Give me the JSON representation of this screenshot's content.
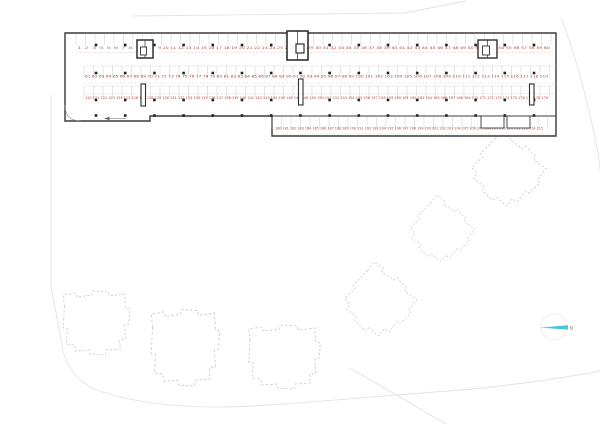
{
  "north": {
    "label": "N"
  },
  "colors": {
    "stall_number_red": "#b0443c",
    "stall_number_gray": "#8f8f8f",
    "north_needle": "#4ac4d8",
    "walls": "#383838"
  },
  "parking_rows": {
    "row1_left": "1 2 3 4 5 6 7 8",
    "row1": "9 10 11 12 13 14 15 16 17 18 19 20 21 22 23 24 25 26 27 28 29 30 31 32 33 34 35 36 37 38 39 40 41 42 43 44 45 46 47 48 49 50 51 52 53 54 55 56 57 58 59 60",
    "row2": "61 62 63 64 65 66 67 68 69 70 71 72 73 74 75 76 77 78 79 80 81 82 83 84 85 86 87 88 89 90 91 92 93 94 95 96 97 98 99 100 101 102 103 104 105 106 107 108 109 110 111 112 113 114 115 116 117 118 119",
    "row3": "120 121 122 123 124 125 126 127 128 129 130 131 132 133 134 135 136 137 138 139 140 141 142 143 144 145 146 147 148 149 150 151 152 153 154 155 156 157 158 159 160 161 162 163 164 165 166 167 168 169 170 171 172 173 174 175 176 177 178 179",
    "row4": "180 181 182 183 184 185 186 187 188 189 190 191 192 193 194 195 196 197 198 199 200 201 202 203 204 205 206 207 208 209 210 211 212 213 214 215"
  }
}
